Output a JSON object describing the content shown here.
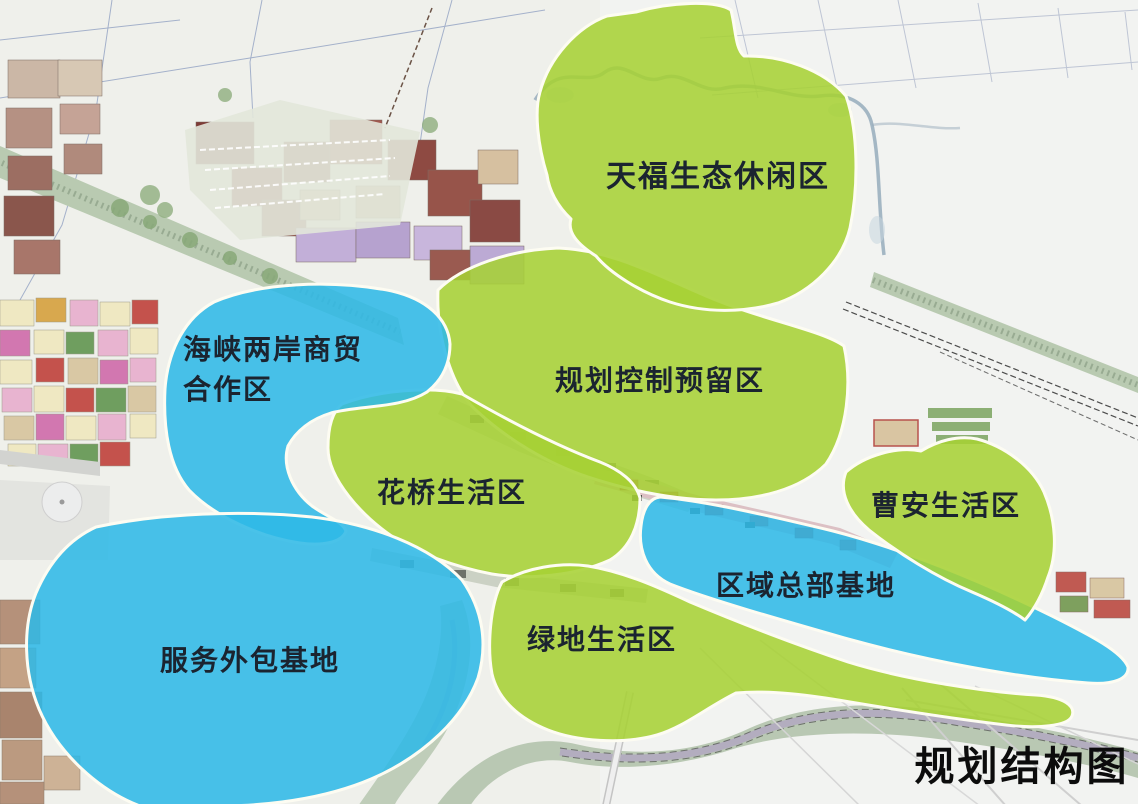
{
  "map": {
    "title": "规划结构图",
    "colors": {
      "green_zone": "#a6d134",
      "blue_zone": "#2eb9e7",
      "zone_outline": "#fdfcf2",
      "label_text": "#1b2430",
      "title_text": "#0c0c0c"
    },
    "zones": {
      "tianfu": {
        "label": "天福生态休闲区",
        "category": "green"
      },
      "guihua": {
        "label": "规划控制预留区",
        "category": "green"
      },
      "huaqiao": {
        "label": "花桥生活区",
        "category": "green"
      },
      "caoan": {
        "label": "曹安生活区",
        "category": "green"
      },
      "lvdi": {
        "label": "绿地生活区",
        "category": "green"
      },
      "haixia": {
        "label": "海峡两岸商贸\n合作区",
        "category": "blue"
      },
      "quyu": {
        "label": "区域总部基地",
        "category": "blue"
      },
      "fuwu": {
        "label": "服务外包基地",
        "category": "blue"
      }
    }
  }
}
